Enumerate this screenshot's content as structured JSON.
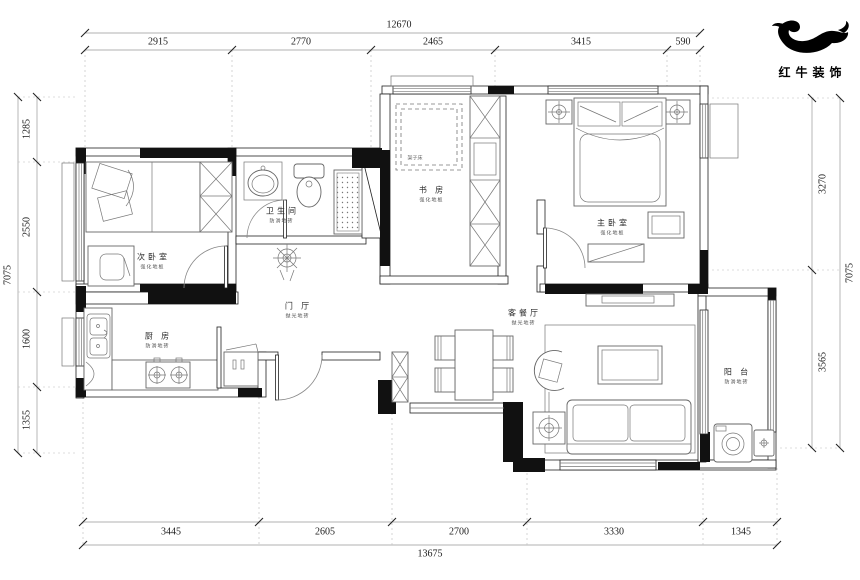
{
  "brand": {
    "name": "红牛装饰"
  },
  "dimensions": {
    "top": {
      "total": "12670",
      "segments": [
        "2915",
        "2770",
        "2465",
        "3415",
        "590"
      ]
    },
    "bottom": {
      "total": "13675",
      "segments": [
        "3445",
        "2605",
        "2700",
        "3330",
        "1345"
      ]
    },
    "left": {
      "total": "7075",
      "segments": [
        "1285",
        "2550",
        "1600",
        "1355"
      ]
    },
    "right": {
      "total": "7075",
      "segments": [
        "3270",
        "3565"
      ]
    }
  },
  "rooms": {
    "bedroom2": {
      "name": "次卧室",
      "material": "强化地板"
    },
    "bathroom": {
      "name": "卫生间",
      "material": "防滑地砖"
    },
    "study": {
      "name": "书 房",
      "material": "强化地板",
      "note": "架子床"
    },
    "master": {
      "name": "主卧室",
      "material": "强化地板"
    },
    "hall": {
      "name": "门 厅",
      "material": "抛光地砖"
    },
    "kitchen": {
      "name": "厨 房",
      "material": "防滑地砖"
    },
    "living": {
      "name": "客餐厅",
      "material": "抛光地砖"
    },
    "balcony": {
      "name": "阳 台",
      "material": "防滑地砖"
    }
  }
}
